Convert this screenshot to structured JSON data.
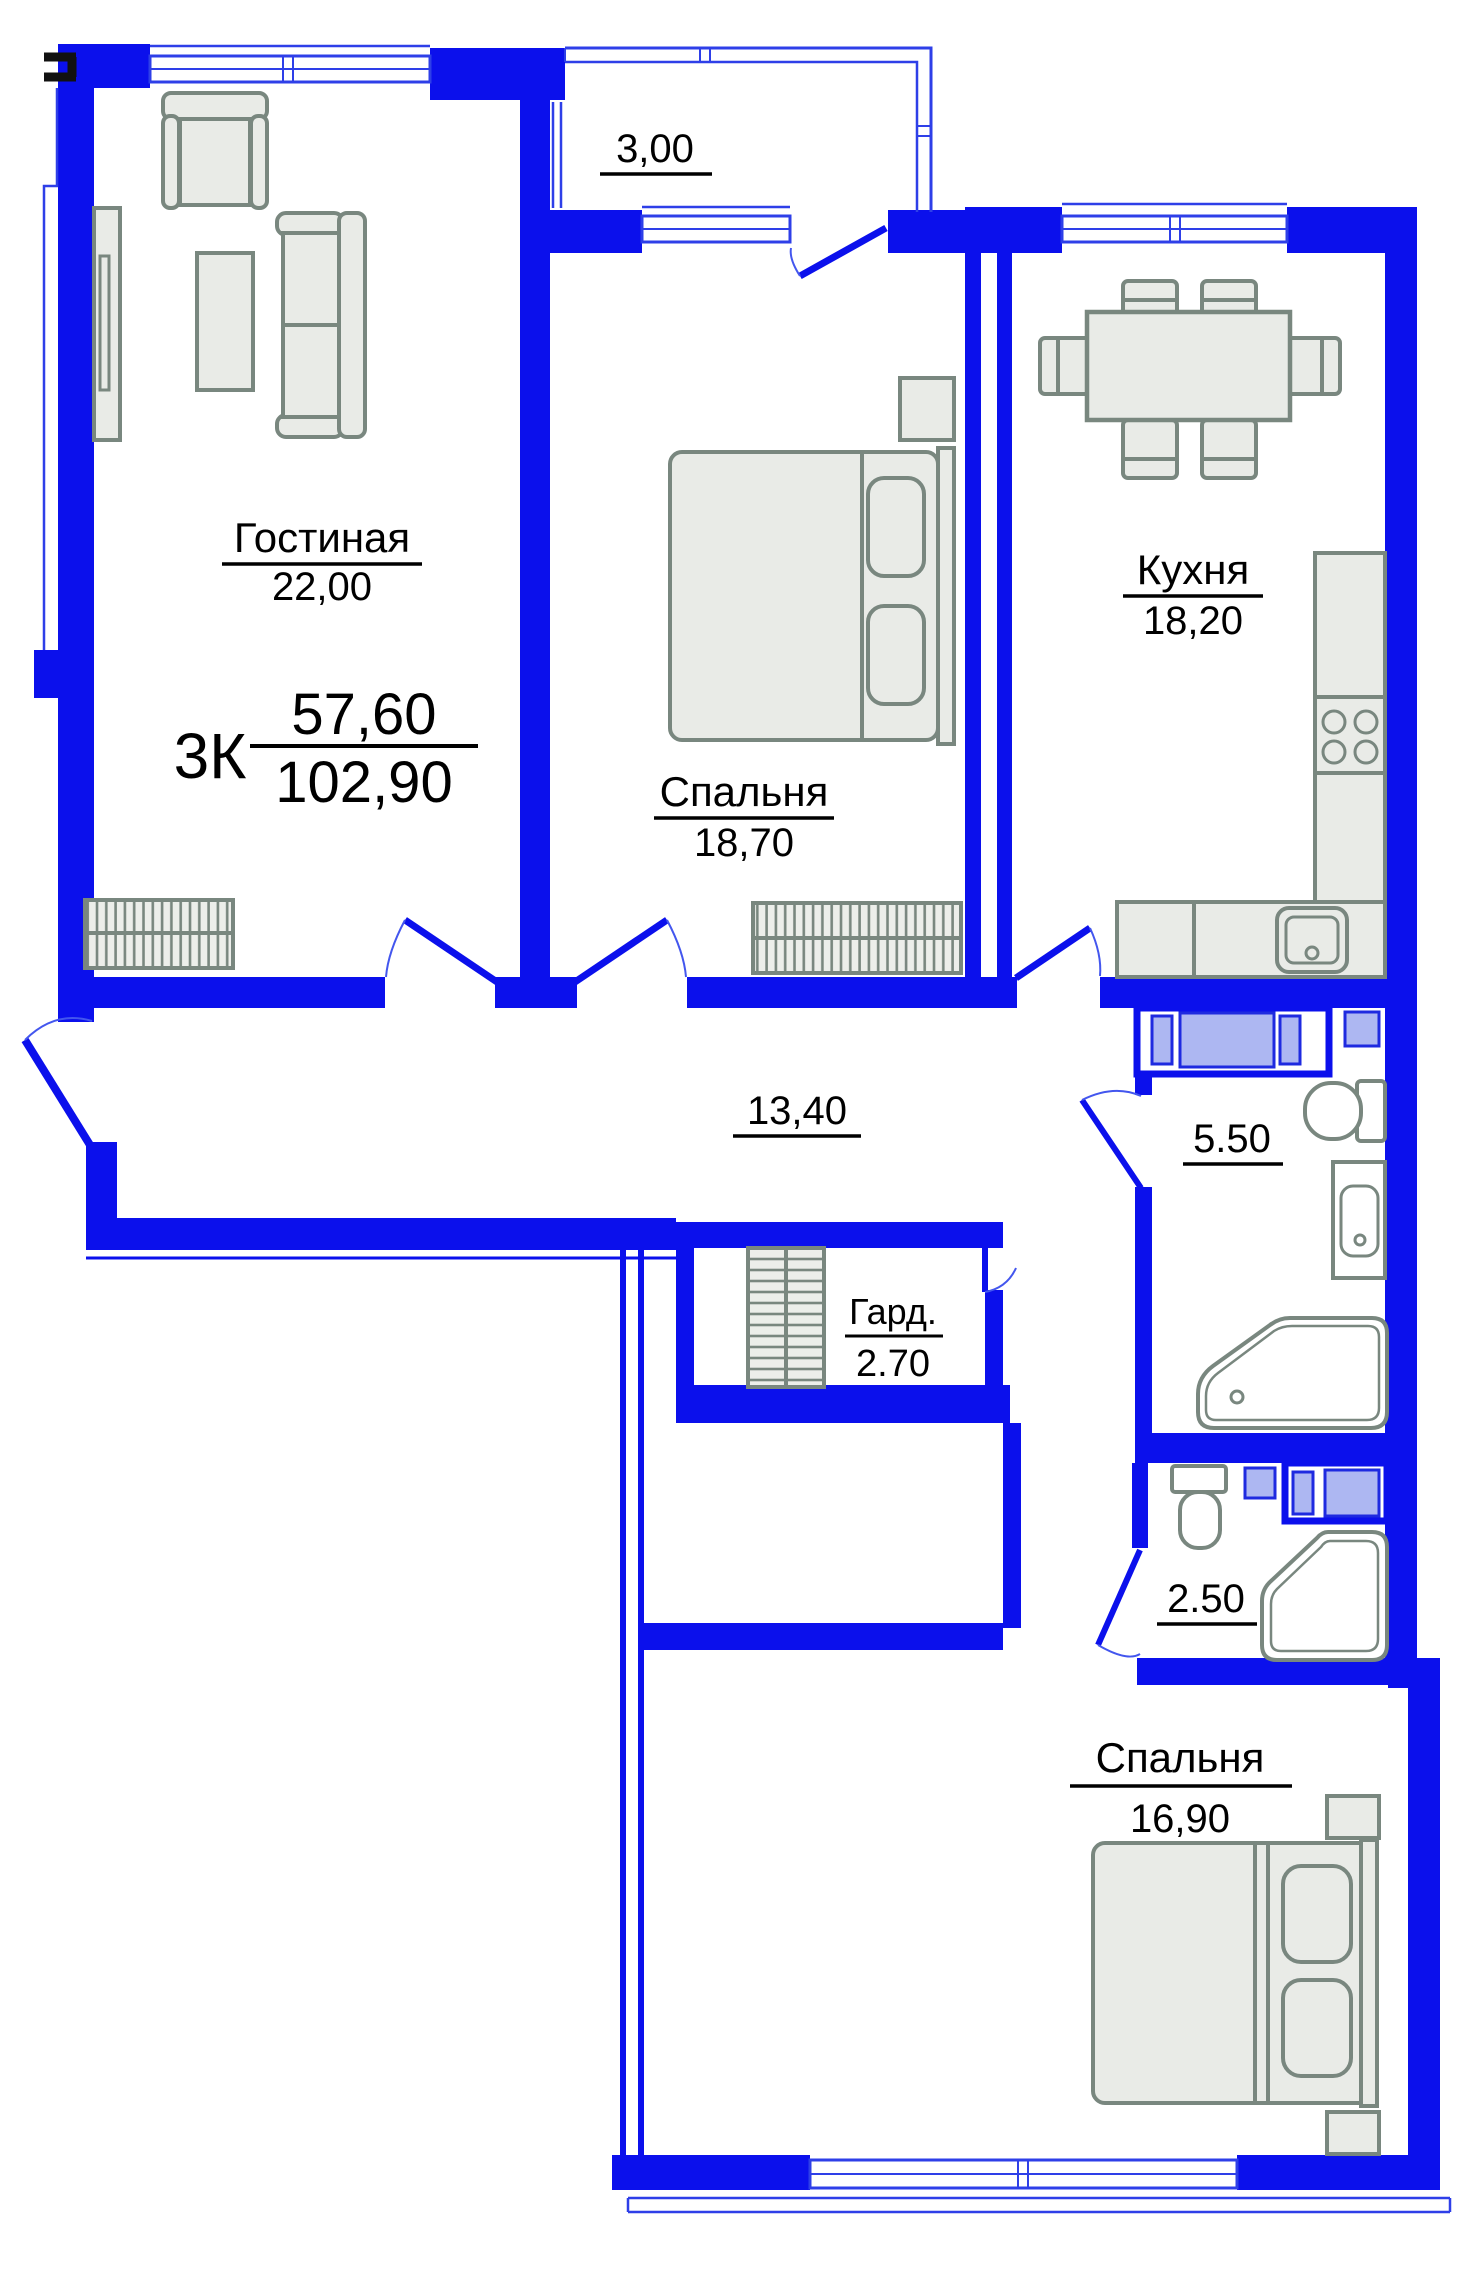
{
  "plan_title": "apartment-floor-plan",
  "summary": {
    "type_label": "3К",
    "upper_value": "57,60",
    "lower_value": "102,90"
  },
  "rooms": {
    "living": {
      "name": "Гостиная",
      "area": "22,00"
    },
    "bedroom1": {
      "name": "Спальня",
      "area": "18,70"
    },
    "kitchen": {
      "name": "Кухня",
      "area": "18,20"
    },
    "balcony": {
      "area": "3,00"
    },
    "hallway": {
      "area": "13,40"
    },
    "wardrobe": {
      "name": "Гард.",
      "area": "2.70"
    },
    "bathroom": {
      "area": "5.50"
    },
    "wc": {
      "area": "2.50"
    },
    "bedroom2": {
      "name": "Спальня",
      "area": "16,90"
    }
  },
  "colors": {
    "wall": "#0b10ec",
    "thin_line": "#2e3fe8",
    "door_arc": "#4356ee",
    "furniture_fill": "#e9ebe7",
    "furniture_stroke": "#79877f",
    "appliance_fill": "#adb7f2",
    "appliance_stroke": "#1e2ae0",
    "text": "#000000",
    "background": "#ffffff"
  }
}
